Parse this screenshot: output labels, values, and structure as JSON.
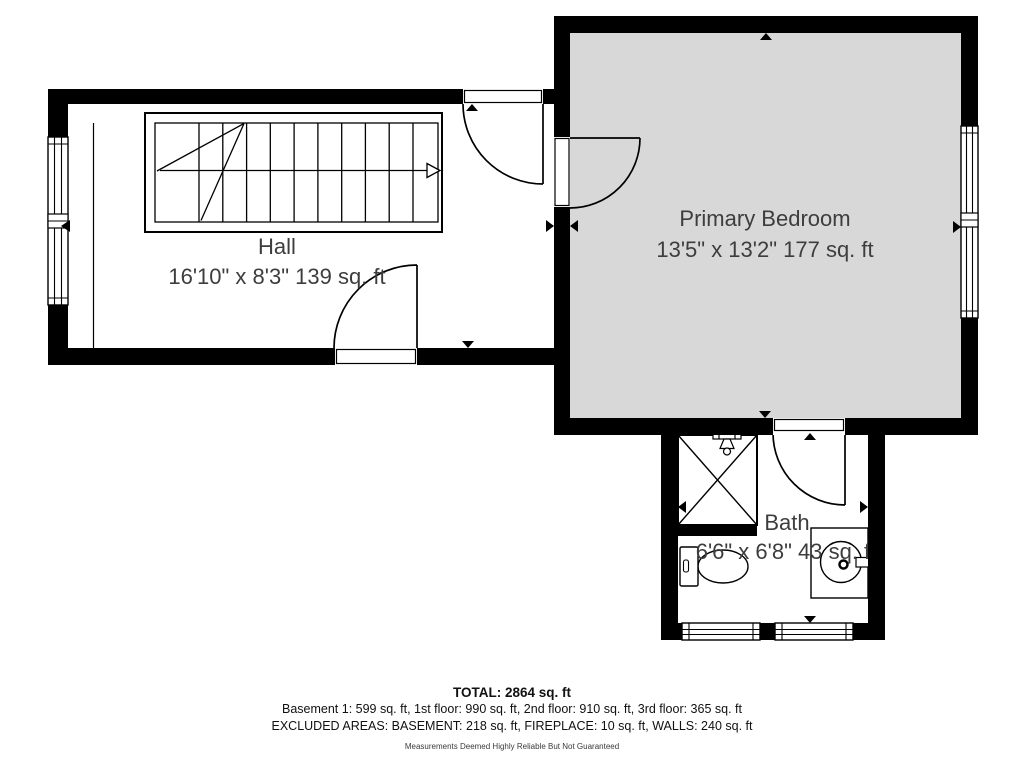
{
  "colors": {
    "wall": "#000000",
    "room_fill": "#d8d8d8",
    "label": "#3d3d3d"
  },
  "rooms": {
    "hall": {
      "name": "Hall",
      "dims": "16'10\" x 8'3\" 139 sq. ft"
    },
    "primary_bedroom": {
      "name": "Primary Bedroom",
      "dims": "13'5\" x 13'2\" 177 sq. ft"
    },
    "bath": {
      "name": "Bath",
      "dims": "6'6\" x 6'8\" 43 sq. ft"
    }
  },
  "footer": {
    "total": "TOTAL: 2864 sq. ft",
    "floors": "Basement 1: 599 sq. ft, 1st floor: 990 sq. ft, 2nd floor: 910 sq. ft, 3rd floor: 365 sq. ft",
    "excluded": "EXCLUDED AREAS: BASEMENT: 218 sq. ft, FIREPLACE: 10 sq. ft, WALLS: 240 sq. ft",
    "disclaimer": "Measurements Deemed Highly Reliable But Not Guaranteed"
  }
}
